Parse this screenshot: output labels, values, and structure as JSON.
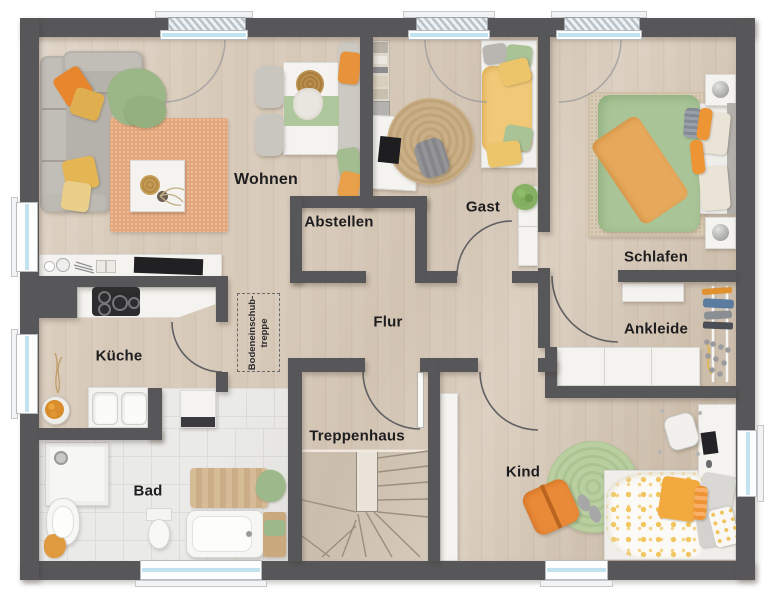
{
  "plan": {
    "rooms": [
      {
        "id": "wohnen",
        "label": "Wohnen"
      },
      {
        "id": "abstellen",
        "label": "Abstellen"
      },
      {
        "id": "gast",
        "label": "Gast"
      },
      {
        "id": "schlafen",
        "label": "Schlafen"
      },
      {
        "id": "kueche",
        "label": "Küche"
      },
      {
        "id": "flur",
        "label": "Flur"
      },
      {
        "id": "ankleide",
        "label": "Ankleide"
      },
      {
        "id": "bad",
        "label": "Bad"
      },
      {
        "id": "treppenhaus",
        "label": "Treppenhaus"
      },
      {
        "id": "kind",
        "label": "Kind"
      }
    ],
    "annotations": {
      "attic_ladder_line1": "Bodeneinschub-",
      "attic_ladder_line2": "treppe"
    },
    "colors": {
      "wall": "#57575a",
      "floor_wood": "#d7c9b8",
      "floor_tile": "#eaeae8",
      "window_glass": "#c3e2f0",
      "accent_orange": "#e8872e",
      "accent_green": "#a9c497",
      "accent_yellow": "#ecc46a",
      "rug_terracotta": "#e2a67c"
    }
  }
}
